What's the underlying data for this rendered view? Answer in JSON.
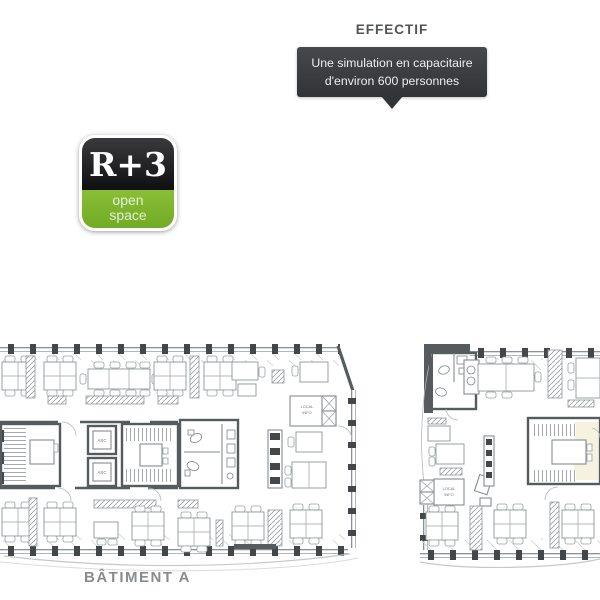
{
  "header": {
    "title": "EFFECTIF",
    "callout_line1": "Une simulation en capacitaire",
    "callout_line2": "d'environ 600 personnes"
  },
  "badge": {
    "floor": "R+3",
    "subtitle_line1": "open",
    "subtitle_line2": "space"
  },
  "plans": {
    "building_a_label": "BÂTIMENT A",
    "elevator_label": "ASC",
    "local_room_line1": "LOCAL",
    "local_room_line2": "INFO"
  },
  "colors": {
    "callout_bg": "#3b3e41",
    "title_text": "#515456",
    "badge_black": "#17171a",
    "badge_green": "#7cb52d",
    "plan_wall": "#565b5e",
    "plan_line": "#8f969a",
    "restroom_fill": "#d8ecec",
    "stair_room_fill": "#f6f2df",
    "building_label_text": "#898c8e"
  }
}
